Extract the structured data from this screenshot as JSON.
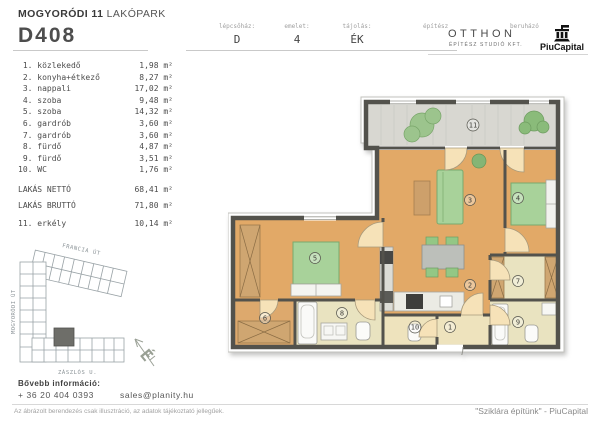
{
  "header": {
    "project_bold": "MOGYORÓDI 11",
    "project_regular": " LAKÓPARK",
    "unit_id": "D408",
    "fields": [
      {
        "label": "lépcsőház:",
        "value": "D"
      },
      {
        "label": "emelet:",
        "value": "4"
      },
      {
        "label": "tájolás:",
        "value": "ÉK"
      }
    ],
    "architect_label": "építész",
    "architect_name": "OTTHON",
    "architect_sub": "ÉPÍTÉSZ STUDIÓ KFT.",
    "developer_label": "beruházó",
    "developer_name": "PiuCapital"
  },
  "rooms": [
    {
      "label": " 1. közlekedő",
      "area": "1,98 m²"
    },
    {
      "label": " 2. konyha+étkező",
      "area": "8,27 m²"
    },
    {
      "label": " 3. nappali",
      "area": "17,02 m²"
    },
    {
      "label": " 4. szoba",
      "area": "9,48 m²"
    },
    {
      "label": " 5. szoba",
      "area": "14,32 m²"
    },
    {
      "label": " 6. gardrób",
      "area": "3,60 m²"
    },
    {
      "label": " 7. gardrób",
      "area": "3,60 m²"
    },
    {
      "label": " 8. fürdő",
      "area": "4,87 m²"
    },
    {
      "label": " 9. fürdő",
      "area": "3,51 m²"
    },
    {
      "label": "10. WC",
      "area": "1,76 m²"
    }
  ],
  "summary": [
    {
      "label": "LAKÁS NETTÓ",
      "area": "68,41 m²"
    },
    {
      "label": "LAKÁS BRUTTÓ",
      "area": "71,80 m²"
    }
  ],
  "extra_room": {
    "label": "11. erkély",
    "area": "10,14 m²"
  },
  "site_map": {
    "streets": [
      "FRANCIA ÚT",
      "MOGYORÓDI ÚT",
      "ZÁSZLÓS U."
    ],
    "compass": "É"
  },
  "plan": {
    "labels": [
      "1",
      "2",
      "3",
      "4",
      "5",
      "6",
      "7",
      "8",
      "9",
      "10",
      "11"
    ]
  },
  "footer": {
    "info_title": "Bővebb információ:",
    "phone": "+ 36 20 404 0393",
    "email": "sales@planity.hu",
    "disclaimer": "Az ábrázolt berendezés csak illusztráció, az adatok tájékoztató jellegűek.",
    "slogan": "\"Sziklára építünk\" - PiuCapital"
  },
  "colors": {
    "wall": "#53524c",
    "floor_living": "#e2a967",
    "floor_wet": "#e9e3c0",
    "floor_hall": "#eee3bd",
    "balcony": "#d8d7d1",
    "furniture_green": "#a8d29a",
    "wood": "#cfa671"
  }
}
